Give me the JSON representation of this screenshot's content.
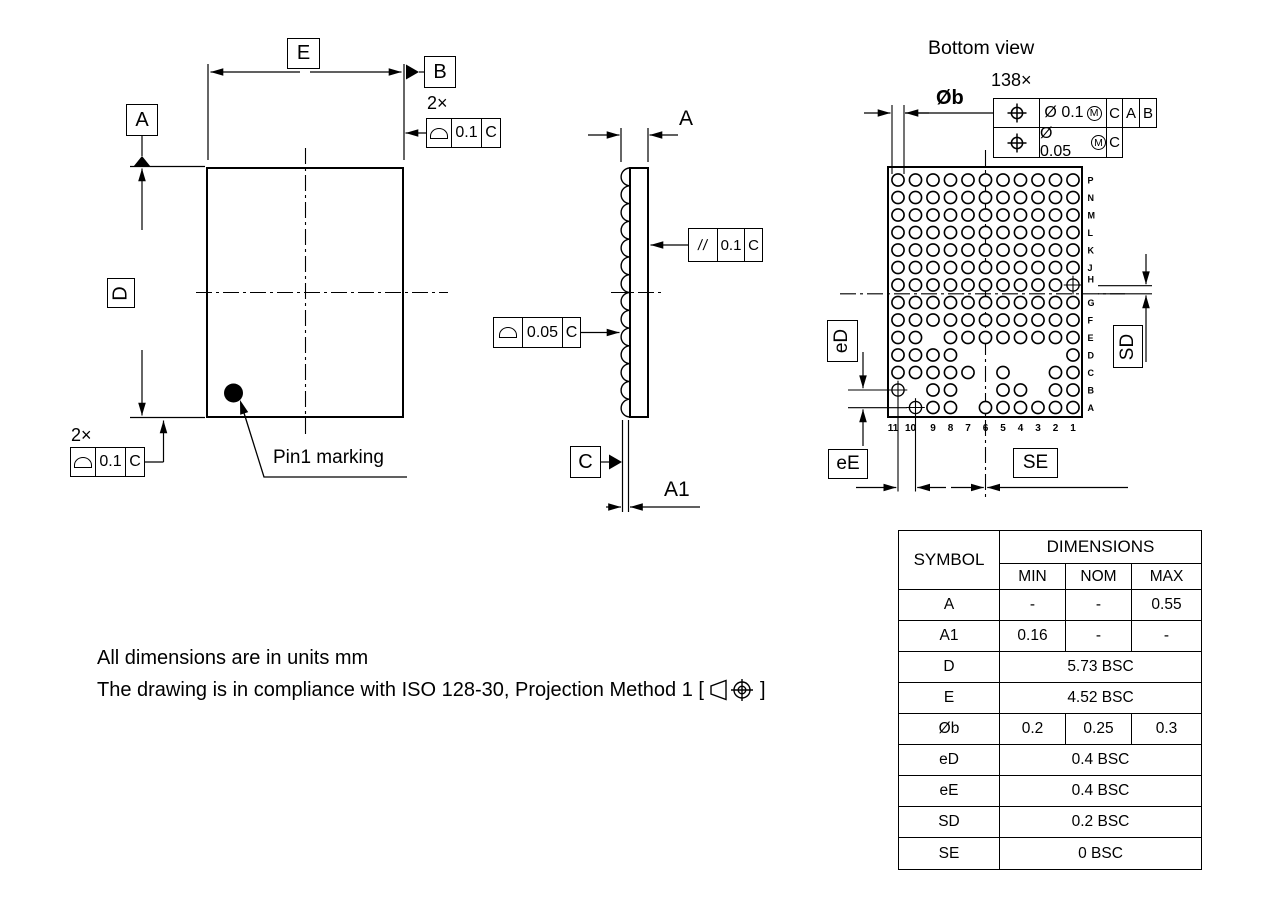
{
  "front_view": {
    "dim_e_label": "E",
    "dim_d_label": "D",
    "datum_a_label": "A",
    "datum_b_label": "B",
    "qty_top": "2×",
    "fcf_top": {
      "tolerance": "0.1",
      "datum": "C"
    },
    "qty_bottom": "2×",
    "fcf_bottom": {
      "tolerance": "0.1",
      "datum": "C"
    },
    "pin1_label": "Pin1 marking"
  },
  "side_view": {
    "dim_a_label": "A",
    "dim_a1_label": "A1",
    "datum_c_label": "C",
    "fcf_parallelism": {
      "symbol": "//",
      "tolerance": "0.1",
      "datum": "C"
    },
    "fcf_profile": {
      "tolerance": "0.05",
      "datum": "C"
    }
  },
  "bottom_view": {
    "title": "Bottom view",
    "ball_count": "138×",
    "dim_ob_label": "Øb",
    "fcf_position": {
      "rows": [
        {
          "tolerance": "Ø 0.1",
          "modifier": "M",
          "datums": [
            "C",
            "A",
            "B"
          ]
        },
        {
          "tolerance": "Ø 0.05",
          "modifier": "M",
          "datums": [
            "C"
          ]
        }
      ]
    },
    "dim_ed_label": "eD",
    "dim_ee_label": "eE",
    "dim_sd_label": "SD",
    "dim_se_label": "SE",
    "grid": {
      "col_labels": [
        "11",
        "10",
        "9",
        "8",
        "7",
        "6",
        "5",
        "4",
        "3",
        "2",
        "1"
      ],
      "rows": [
        {
          "label": "P",
          "balls": [
            11,
            10,
            9,
            8,
            7,
            6,
            5,
            4,
            3,
            2,
            1
          ],
          "targets": []
        },
        {
          "label": "N",
          "balls": [
            11,
            10,
            9,
            8,
            7,
            6,
            5,
            4,
            3,
            2,
            1
          ],
          "targets": []
        },
        {
          "label": "M",
          "balls": [
            11,
            10,
            9,
            8,
            7,
            6,
            5,
            4,
            3,
            2,
            1
          ],
          "targets": []
        },
        {
          "label": "L",
          "balls": [
            11,
            10,
            9,
            8,
            7,
            6,
            5,
            4,
            3,
            2,
            1
          ],
          "targets": []
        },
        {
          "label": "K",
          "balls": [
            11,
            10,
            9,
            8,
            7,
            6,
            5,
            4,
            3,
            2,
            1
          ],
          "targets": []
        },
        {
          "label": "J",
          "balls": [
            11,
            10,
            9,
            8,
            7,
            6,
            5,
            4,
            3,
            2,
            1
          ],
          "targets": []
        },
        {
          "label": "H",
          "balls": [
            11,
            10,
            9,
            8,
            7,
            6,
            5,
            4,
            3,
            2
          ],
          "targets": [
            1
          ]
        },
        {
          "label": "G",
          "balls": [
            11,
            10,
            9,
            8,
            7,
            6,
            5,
            4,
            3,
            2,
            1
          ],
          "targets": []
        },
        {
          "label": "F",
          "balls": [
            11,
            10,
            9,
            8,
            7,
            6,
            5,
            4,
            3,
            2,
            1
          ],
          "targets": []
        },
        {
          "label": "E",
          "balls": [
            11,
            10,
            8,
            7,
            6,
            5,
            4,
            3,
            2,
            1
          ],
          "targets": []
        },
        {
          "label": "D",
          "balls": [
            11,
            10,
            9,
            8,
            1
          ],
          "targets": []
        },
        {
          "label": "C",
          "balls": [
            11,
            10,
            9,
            8,
            7,
            5,
            2,
            1
          ],
          "targets": []
        },
        {
          "label": "B",
          "balls": [
            9,
            8,
            5,
            4,
            2,
            1
          ],
          "targets": [
            11
          ]
        },
        {
          "label": "A",
          "balls": [
            9,
            8,
            6,
            5,
            4,
            3,
            2,
            1
          ],
          "targets": [
            10
          ]
        }
      ]
    }
  },
  "table": {
    "symbol_header": "SYMBOL",
    "dimensions_header": "DIMENSIONS",
    "min_header": "MIN",
    "nom_header": "NOM",
    "max_header": "MAX",
    "rows": [
      {
        "symbol": "A",
        "min": "-",
        "nom": "-",
        "max": "0.55"
      },
      {
        "symbol": "A1",
        "min": "0.16",
        "nom": "-",
        "max": "-"
      },
      {
        "symbol": "D",
        "span": "5.73 BSC"
      },
      {
        "symbol": "E",
        "span": "4.52 BSC"
      },
      {
        "symbol": "Øb",
        "min": "0.2",
        "nom": "0.25",
        "max": "0.3"
      },
      {
        "symbol": "eD",
        "span": "0.4 BSC"
      },
      {
        "symbol": "eE",
        "span": "0.4 BSC"
      },
      {
        "symbol": "SD",
        "span": "0.2 BSC"
      },
      {
        "symbol": "SE",
        "span": "0 BSC"
      }
    ]
  },
  "notes": {
    "line1": "All dimensions are in units mm",
    "line2_prefix": "The drawing is in compliance with ISO 128-30, Projection Method 1 [",
    "line2_suffix": "]"
  }
}
